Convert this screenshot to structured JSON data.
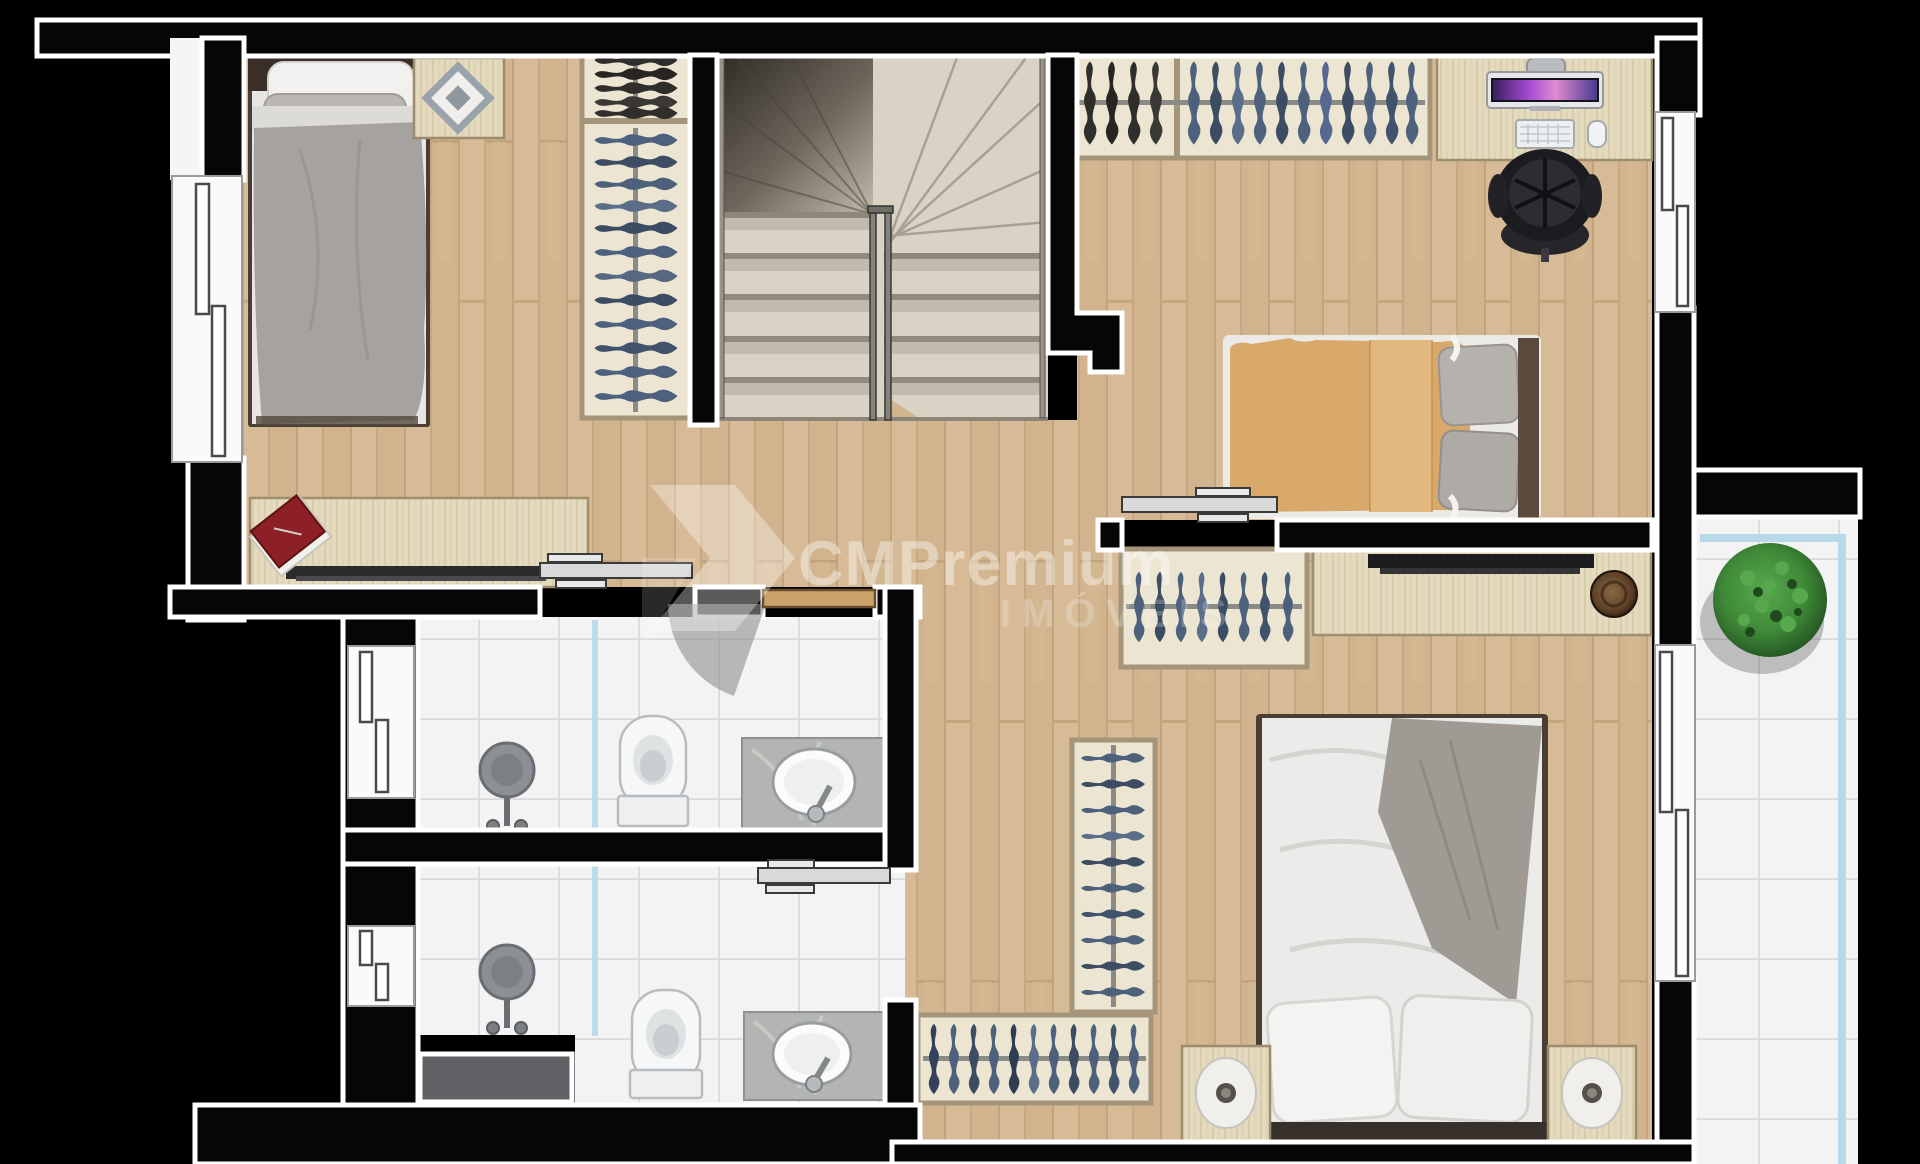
{
  "watermark": {
    "brand": "CMPremium",
    "subtitle": "IMÓVEIS"
  },
  "palette": {
    "background": "#000000",
    "wall": "#060606",
    "wall_outline": "#ffffff",
    "wood_floor": "#d7bb97",
    "stair": "#d9d3c6",
    "tile": "#f3f3f4",
    "tile_grid": "#dadadd",
    "glass": "#b5d9e8",
    "marble": "#b2b5b1",
    "bed_gray": "#a5a29f",
    "bed_tan": "#d9a96c",
    "bed_white": "#ebebe9",
    "clothes_blue": "#4e617c",
    "clothes_dark": "#2f2e2c",
    "plant_green": "#3f8a38",
    "screen_purple": "#a64bd4",
    "book_red": "#8d2026"
  },
  "plan": {
    "floor_name": "upper floor plan",
    "rooms": [
      {
        "name": "bedroom-1",
        "furniture": [
          "single-bed",
          "side-table",
          "wardrobe",
          "desk-dresser",
          "red-book"
        ]
      },
      {
        "name": "stairwell",
        "furniture": [
          "u-shaped-stairs",
          "handrail"
        ]
      },
      {
        "name": "bedroom-2",
        "furniture": [
          "wardrobe",
          "computer-desk",
          "monitor",
          "keyboard",
          "mouse",
          "office-chair",
          "double-bed-tan"
        ]
      },
      {
        "name": "bathroom-1",
        "furniture": [
          "shower",
          "glass-divider",
          "toilet",
          "vanity-sink",
          "hinged-door"
        ]
      },
      {
        "name": "bathroom-2",
        "furniture": [
          "shower",
          "glass-divider",
          "toilet",
          "vanity-sink",
          "mat",
          "sliding-door"
        ]
      },
      {
        "name": "master-bedroom",
        "furniture": [
          "wardrobe-top",
          "sideboard-tv",
          "decor-bowl",
          "wardrobe-vertical",
          "wardrobe-bottom",
          "double-bed-white",
          "nightstand-left",
          "nightstand-right"
        ]
      },
      {
        "name": "balcony",
        "furniture": [
          "round-plant",
          "glass-railing"
        ]
      }
    ]
  }
}
